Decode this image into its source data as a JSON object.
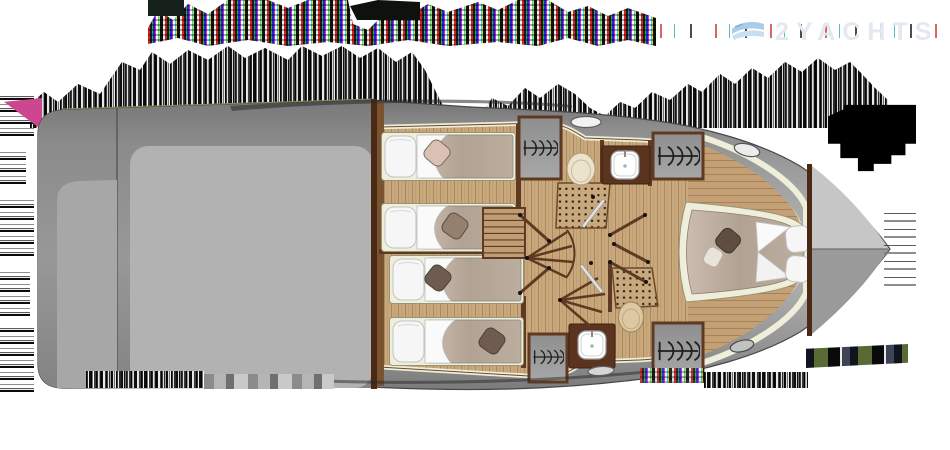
{
  "meta": {
    "type": "yacht-deck-plan",
    "view": "overhead",
    "bow_direction": "right"
  },
  "watermark": {
    "brand": "2YACHTS",
    "logo": "waves-logo-icon"
  },
  "fixtures": {
    "single_berths": 4,
    "double_berths": 1,
    "wardrobes": 4,
    "toilets": 2,
    "sinks": 2,
    "shower_mats": 2,
    "staircases": 2,
    "deck_hatches": 4,
    "cabin_doors": 5
  },
  "colors": {
    "hull_gray": "#9a9a9a",
    "deck_light": "#b4b4b4",
    "wood": "#c9a87c",
    "wood_line": "#a3835c",
    "trim": "#5d3a21",
    "cream": "#eeeedb",
    "blanket": "#b3a496",
    "pillow": "#f6f6f6",
    "cushion": "#6e5c50",
    "counter": "#5a341e",
    "glitch_pink": "#cc4790",
    "wm_text": "#e3e9f0",
    "wm_logo": "#a9cde8"
  }
}
